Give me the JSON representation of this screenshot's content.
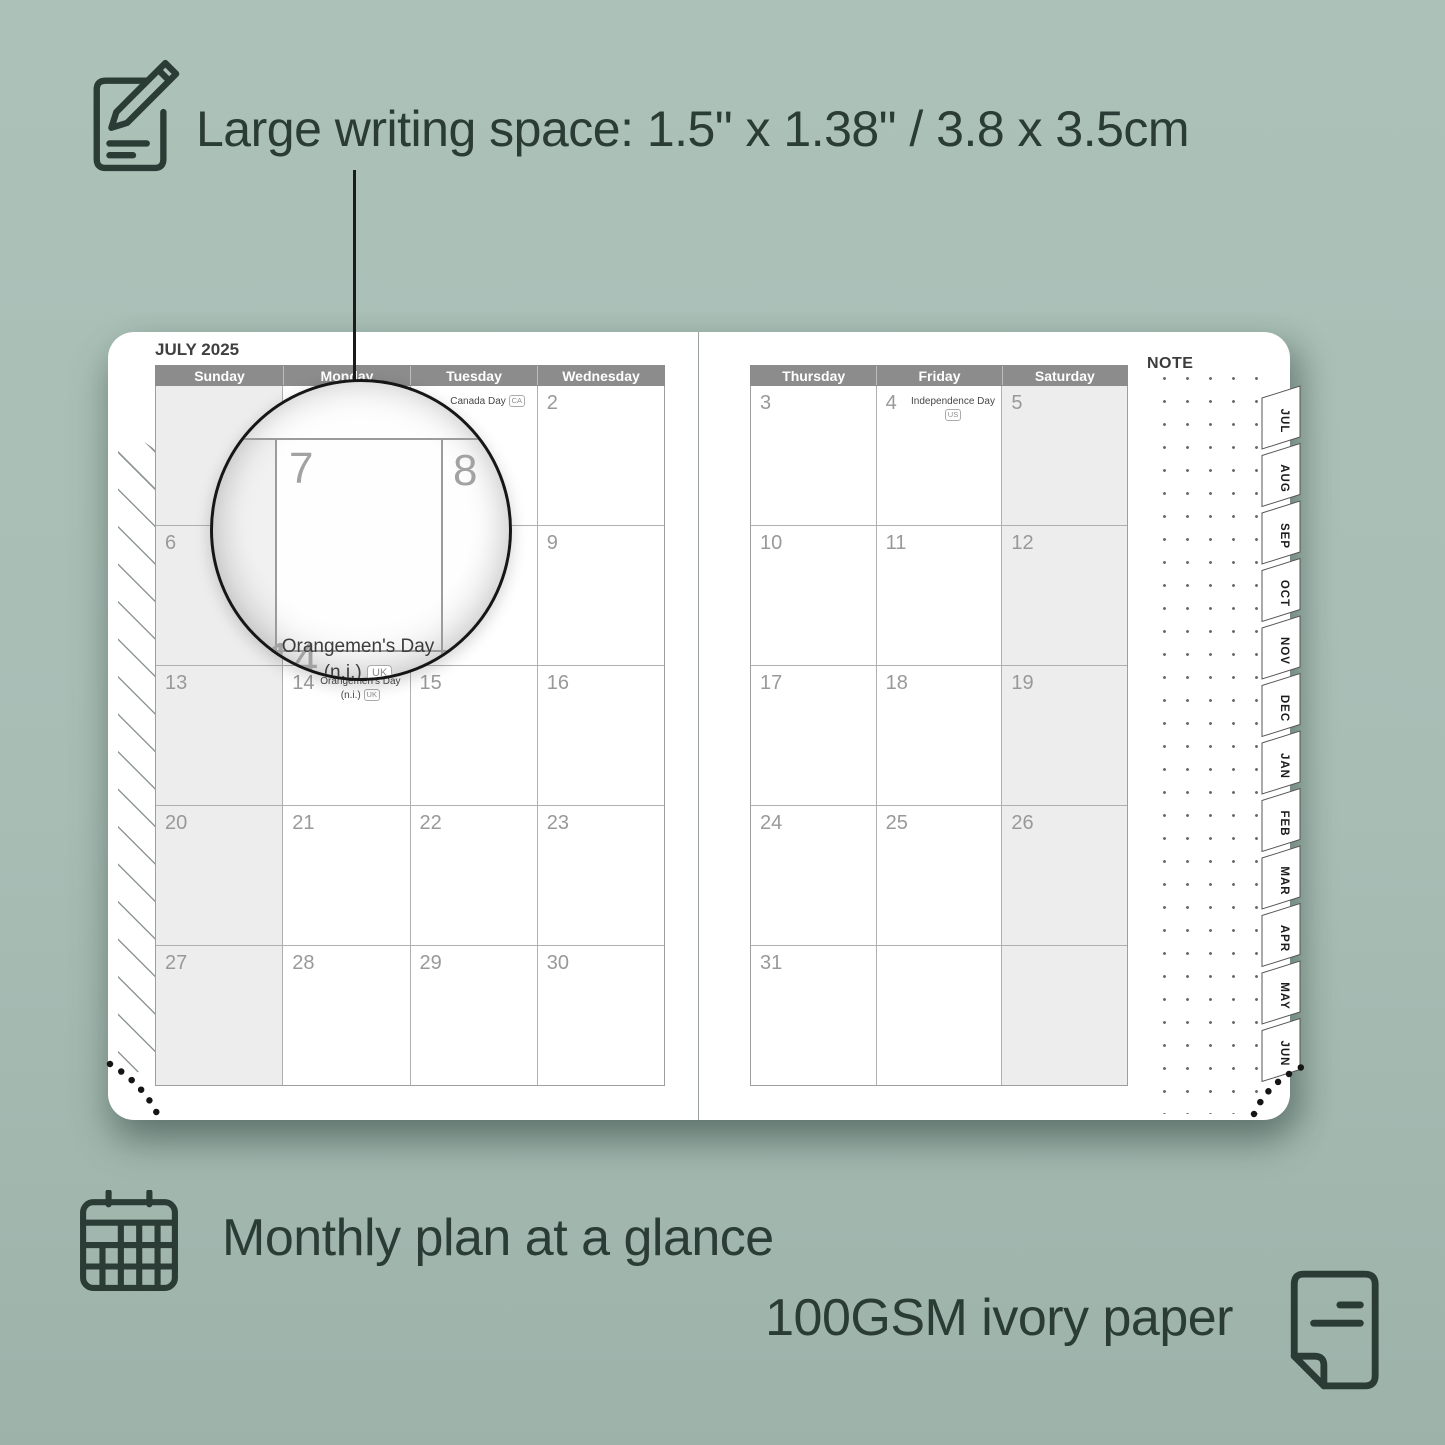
{
  "product": {
    "features": {
      "writing_space": "Large writing space: 1.5\" x 1.38\" / 3.8 x 3.5cm",
      "monthly_plan": "Monthly plan at a glance",
      "paper": "100GSM ivory paper"
    }
  },
  "planner": {
    "month_title": "JULY 2025",
    "note_label": "NOTE",
    "left_page": {
      "day_headers": [
        "Sunday",
        "Monday",
        "Tuesday",
        "Wednesday"
      ],
      "shaded_columns": [
        0
      ],
      "rows": [
        [
          {
            "num": ""
          },
          {
            "num": ""
          },
          {
            "num": "1",
            "holiday": "Canada Day",
            "badge": "CA"
          },
          {
            "num": "2"
          }
        ],
        [
          {
            "num": "6"
          },
          {
            "num": "7"
          },
          {
            "num": "8"
          },
          {
            "num": "9"
          }
        ],
        [
          {
            "num": "13"
          },
          {
            "num": "14",
            "holiday": "Orangemen's Day (n.i.)",
            "badge": "UK"
          },
          {
            "num": "15"
          },
          {
            "num": "16"
          }
        ],
        [
          {
            "num": "20"
          },
          {
            "num": "21"
          },
          {
            "num": "22"
          },
          {
            "num": "23"
          }
        ],
        [
          {
            "num": "27"
          },
          {
            "num": "28"
          },
          {
            "num": "29"
          },
          {
            "num": "30"
          }
        ]
      ]
    },
    "right_page": {
      "day_headers": [
        "Thursday",
        "Friday",
        "Saturday"
      ],
      "shaded_columns": [
        2
      ],
      "rows": [
        [
          {
            "num": "3"
          },
          {
            "num": "4",
            "holiday": "Independence Day",
            "badge": "US"
          },
          {
            "num": "5"
          }
        ],
        [
          {
            "num": "10"
          },
          {
            "num": "11"
          },
          {
            "num": "12"
          }
        ],
        [
          {
            "num": "17"
          },
          {
            "num": "18"
          },
          {
            "num": "19"
          }
        ],
        [
          {
            "num": "24"
          },
          {
            "num": "25"
          },
          {
            "num": "26"
          }
        ],
        [
          {
            "num": "31"
          },
          {
            "num": ""
          },
          {
            "num": ""
          }
        ]
      ]
    },
    "month_tabs": [
      "JUL",
      "AUG",
      "SEP",
      "OCT",
      "NOV",
      "DEC",
      "JAN",
      "FEB",
      "MAR",
      "APR",
      "MAY",
      "JUN"
    ],
    "magnifier": {
      "day_top_left": "7",
      "day_top_right": "8",
      "day_bottom": "14",
      "holiday_line1": "Orangemen's Day",
      "holiday_line2": "(n.i.)",
      "badge": "UK"
    }
  },
  "colors": {
    "background": "#a9bfb6",
    "page": "#ffffff",
    "header_bar": "#8c8c8c",
    "shaded_column": "#ededed",
    "ink": "#2b3b35",
    "day_number": "#999999"
  }
}
